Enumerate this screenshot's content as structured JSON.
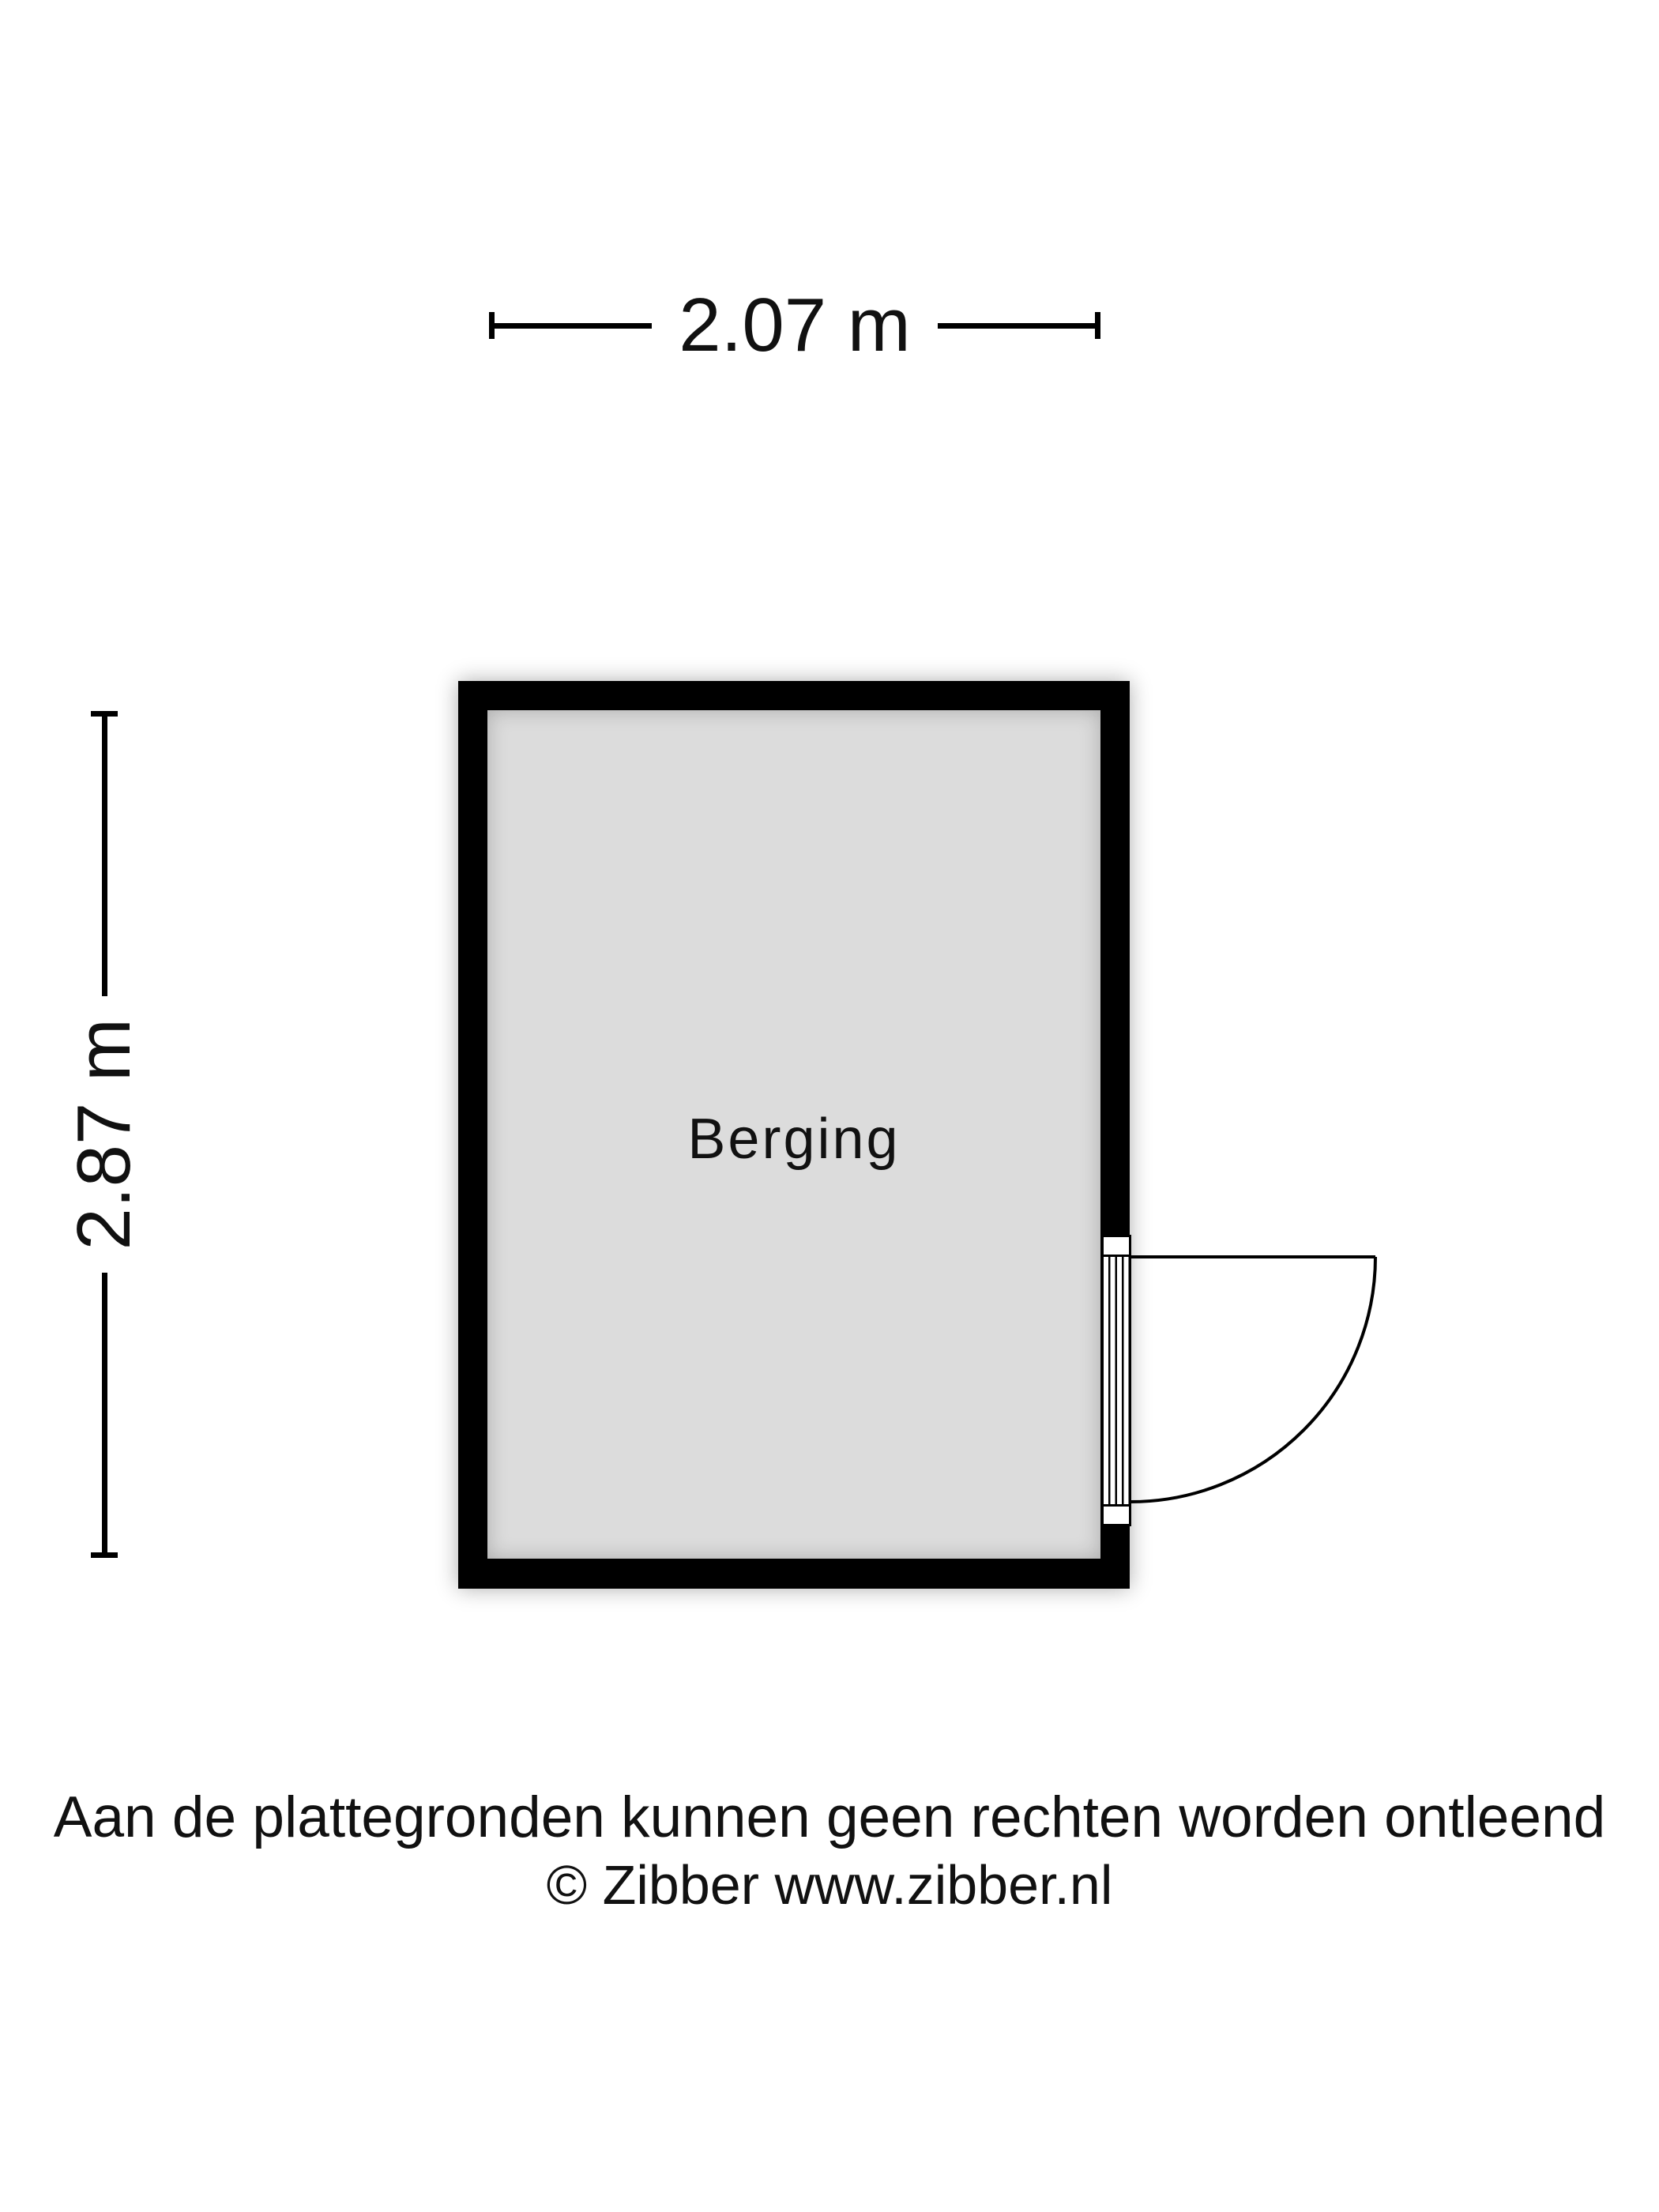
{
  "floorplan": {
    "room": {
      "label": "Berging"
    },
    "dimensions": {
      "width_label": "2.07 m",
      "height_label": "2.87 m"
    }
  },
  "footer": {
    "disclaimer": "Aan de plattegronden kunnen geen rechten worden ontleend",
    "copyright": "© Zibber www.zibber.nl"
  },
  "colors": {
    "background": "#ffffff",
    "wall": "#000000",
    "floor": "#dcdcdc",
    "line": "#000000",
    "text": "#111111"
  }
}
